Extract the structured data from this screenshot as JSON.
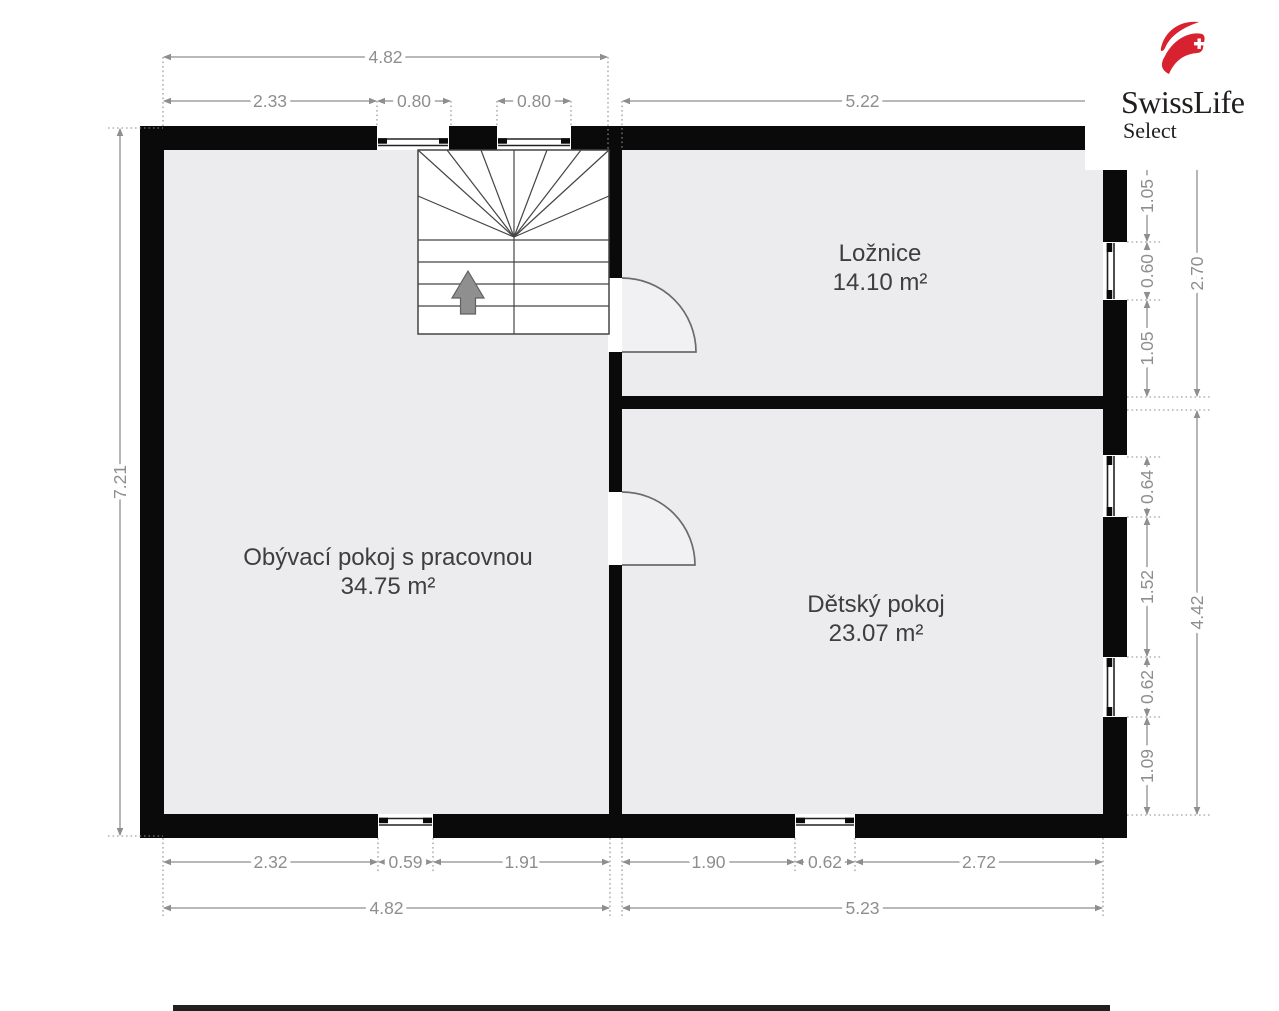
{
  "logo": {
    "brand": "SwissLife",
    "sub": "Select"
  },
  "plan": {
    "colors": {
      "wall": "#0a0a0a",
      "floor": "#ececee",
      "dim": "#8e8e8e",
      "room_text": "#3e3e3e",
      "stair_line": "#454545",
      "door": "#6b6b6b",
      "glass": "#222222",
      "logo_red": "#d9222f",
      "swing_fill": "#f1f1f3",
      "edge_bar": "#202020"
    },
    "rooms": [
      {
        "name": "Ložnice",
        "area": "14.10 m²",
        "x": 880,
        "y": 261
      },
      {
        "name": "Obývací pokoj s pracovnou",
        "area": "34.75 m²",
        "x": 388,
        "y": 565
      },
      {
        "name": "Dětský pokoj",
        "area": "23.07 m²",
        "x": 876,
        "y": 612
      }
    ],
    "walls": [
      [
        140,
        126,
        987,
        24
      ],
      [
        140,
        814,
        987,
        24
      ],
      [
        140,
        126,
        24,
        712
      ],
      [
        1103,
        126,
        24,
        712
      ],
      [
        609,
        150,
        13,
        128
      ],
      [
        609,
        352,
        13,
        140
      ],
      [
        609,
        565,
        13,
        249
      ],
      [
        622,
        396,
        481,
        13
      ]
    ],
    "windows": [
      {
        "o": "h",
        "x": 377,
        "y": 126,
        "w": 72,
        "h": 24,
        "side": "bottom"
      },
      {
        "o": "h",
        "x": 497,
        "y": 126,
        "w": 74,
        "h": 24,
        "side": "bottom"
      },
      {
        "o": "h",
        "x": 378,
        "y": 814,
        "w": 55,
        "h": 24,
        "side": "top"
      },
      {
        "o": "h",
        "x": 795,
        "y": 814,
        "w": 60,
        "h": 24,
        "side": "top"
      },
      {
        "o": "v",
        "x": 1103,
        "y": 242,
        "w": 24,
        "h": 58,
        "side": "left"
      },
      {
        "o": "v",
        "x": 1103,
        "y": 455,
        "w": 24,
        "h": 62,
        "side": "left"
      },
      {
        "o": "v",
        "x": 1103,
        "y": 657,
        "w": 24,
        "h": 60,
        "side": "left"
      }
    ],
    "doors": [
      {
        "wx": 608,
        "wy": 278,
        "ww": 15,
        "wh": 74,
        "hx": 622,
        "hy": 352,
        "r": 74
      },
      {
        "wx": 608,
        "wy": 492,
        "ww": 15,
        "wh": 73,
        "hx": 622,
        "hy": 565,
        "r": 73
      }
    ],
    "stairs": {
      "x": 418,
      "y": 150,
      "w": 191,
      "h": 184,
      "fanCx": 514,
      "fanCy": 237,
      "fanTargets": [
        [
          418,
          150
        ],
        [
          418,
          196
        ],
        [
          447,
          150
        ],
        [
          481,
          150
        ],
        [
          514,
          150
        ],
        [
          547,
          150
        ],
        [
          581,
          150
        ],
        [
          609,
          150
        ],
        [
          609,
          196
        ]
      ],
      "treads": [
        240,
        262,
        284,
        306
      ],
      "arrow": {
        "cx": 468,
        "tip": 271,
        "headW": 32,
        "headH": 27,
        "shaftW": 15,
        "bottom": 314
      }
    },
    "dims": [
      {
        "o": "h",
        "label": "4.82",
        "a": 163,
        "b": 608,
        "p": 57
      },
      {
        "o": "h",
        "label": "2.33",
        "a": 163,
        "b": 377,
        "p": 101
      },
      {
        "o": "h",
        "label": "0.80",
        "a": 377,
        "b": 451,
        "p": 101
      },
      {
        "o": "h",
        "label": "0.80",
        "a": 497,
        "b": 571,
        "p": 101
      },
      {
        "o": "h",
        "label": "5.22",
        "a": 622,
        "b": 1103,
        "p": 101
      },
      {
        "o": "v",
        "label": "7.21",
        "a": 128,
        "b": 836,
        "p": 120
      },
      {
        "o": "v",
        "label": "1.05",
        "a": 150,
        "b": 242,
        "p": 1147
      },
      {
        "o": "v",
        "label": "0.60",
        "a": 242,
        "b": 300,
        "p": 1147
      },
      {
        "o": "v",
        "label": "1.05",
        "a": 300,
        "b": 397,
        "p": 1147
      },
      {
        "o": "v",
        "label": "0.64",
        "a": 457,
        "b": 517,
        "p": 1147
      },
      {
        "o": "v",
        "label": "1.52",
        "a": 517,
        "b": 657,
        "p": 1147
      },
      {
        "o": "v",
        "label": "0.62",
        "a": 657,
        "b": 717,
        "p": 1147
      },
      {
        "o": "v",
        "label": "1.09",
        "a": 717,
        "b": 815,
        "p": 1147
      },
      {
        "o": "v",
        "label": "2.70",
        "a": 150,
        "b": 397,
        "p": 1197
      },
      {
        "o": "v",
        "label": "4.42",
        "a": 410,
        "b": 815,
        "p": 1197
      },
      {
        "o": "h",
        "label": "2.32",
        "a": 163,
        "b": 378,
        "p": 862
      },
      {
        "o": "h",
        "label": "0.59",
        "a": 378,
        "b": 433,
        "p": 862
      },
      {
        "o": "h",
        "label": "1.91",
        "a": 433,
        "b": 610,
        "p": 862
      },
      {
        "o": "h",
        "label": "1.90",
        "a": 622,
        "b": 795,
        "p": 862
      },
      {
        "o": "h",
        "label": "0.62",
        "a": 795,
        "b": 855,
        "p": 862
      },
      {
        "o": "h",
        "label": "2.72",
        "a": 855,
        "b": 1103,
        "p": 862
      },
      {
        "o": "h",
        "label": "4.82",
        "a": 163,
        "b": 610,
        "p": 908
      },
      {
        "o": "h",
        "label": "5.23",
        "a": 622,
        "b": 1103,
        "p": 908
      }
    ],
    "ext": [
      [
        163,
        57,
        163,
        126
      ],
      [
        608,
        57,
        608,
        150
      ],
      [
        377,
        101,
        377,
        126
      ],
      [
        451,
        101,
        451,
        126
      ],
      [
        497,
        101,
        497,
        126
      ],
      [
        571,
        101,
        571,
        126
      ],
      [
        622,
        101,
        622,
        150
      ],
      [
        1103,
        101,
        1103,
        126
      ],
      [
        108,
        128,
        163,
        128
      ],
      [
        108,
        836,
        163,
        836
      ],
      [
        1127,
        242,
        1162,
        242
      ],
      [
        1127,
        300,
        1162,
        300
      ],
      [
        1127,
        397,
        1212,
        397
      ],
      [
        1127,
        410,
        1212,
        410
      ],
      [
        1127,
        457,
        1162,
        457
      ],
      [
        1127,
        517,
        1162,
        517
      ],
      [
        1127,
        657,
        1162,
        657
      ],
      [
        1127,
        717,
        1162,
        717
      ],
      [
        1127,
        815,
        1212,
        815
      ],
      [
        163,
        838,
        163,
        916
      ],
      [
        610,
        838,
        610,
        916
      ],
      [
        622,
        838,
        622,
        916
      ],
      [
        1103,
        838,
        1103,
        916
      ],
      [
        378,
        838,
        378,
        872
      ],
      [
        433,
        838,
        433,
        872
      ],
      [
        795,
        838,
        795,
        872
      ],
      [
        855,
        838,
        855,
        872
      ]
    ],
    "bottom_bar": {
      "x": 173,
      "y": 1005,
      "w": 937,
      "h": 6
    }
  }
}
